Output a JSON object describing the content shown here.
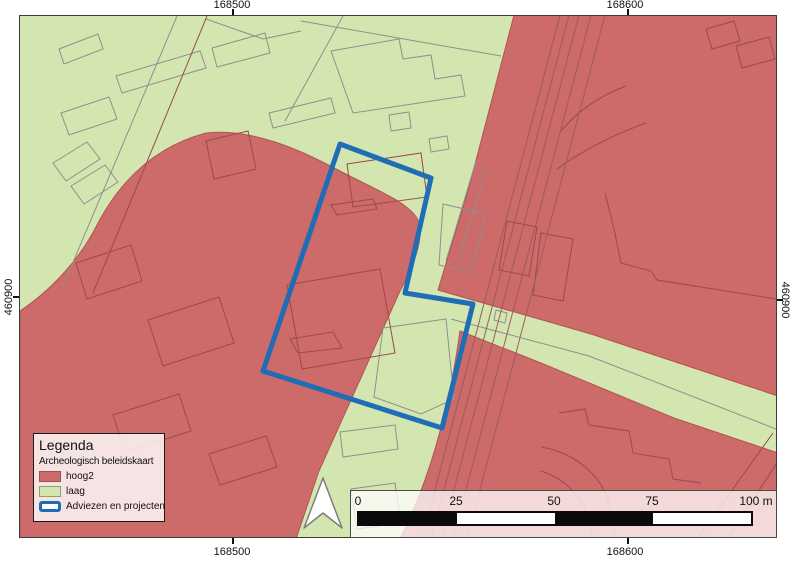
{
  "map_canvas": {
    "colors": {
      "laag": "#d3e6b0",
      "hoog2": "#cd6a6a",
      "hoog2_outline": "#b05454",
      "line_green": "#8f8f8f",
      "line_red": "#994b4b",
      "road": "#9c5d5d",
      "project_outline": "#1e6db6",
      "north_arrow_fill": "#ffffff",
      "north_arrow_stroke": "#7d7d7d"
    },
    "red_regions": [
      {
        "name": "west-high-zone",
        "d": "M19,310 C52,288 80,256 96,224 C118,182 152,146 205,132 C250,127 298,148 337,169 C375,189 408,201 417,219 C424,237 412,266 399,290 L318,470 L295,538 L19,538 Z"
      },
      {
        "name": "northeast-high-zone",
        "d": "M513,14 L777,14 L777,395 L590,333 L437,289 L467,190 Z"
      },
      {
        "name": "southeast-high-zone",
        "d": "M459,330 L540,362 L673,417 L777,452 L777,538 L399,538 Q442,452 459,330 Z"
      }
    ],
    "lines_green": [
      {
        "pts": [
          [
            58,
            48
          ],
          [
            97,
            33
          ],
          [
            102,
            48
          ],
          [
            63,
            63
          ]
        ],
        "closed": true
      },
      {
        "pts": [
          [
            115,
            75
          ],
          [
            199,
            50
          ],
          [
            205,
            67
          ],
          [
            121,
            92
          ]
        ],
        "closed": true
      },
      {
        "pts": [
          [
            60,
            112
          ],
          [
            108,
            96
          ],
          [
            116,
            118
          ],
          [
            68,
            134
          ]
        ],
        "closed": true
      },
      {
        "pts": [
          [
            211,
            47
          ],
          [
            264,
            32
          ],
          [
            269,
            52
          ],
          [
            216,
            66
          ]
        ],
        "closed": true
      },
      {
        "pts": [
          [
            205,
            18
          ],
          [
            262,
            38
          ],
          [
            300,
            30
          ]
        ],
        "closed": false
      },
      {
        "pts": [
          [
            268,
            112
          ],
          [
            330,
            97
          ],
          [
            334,
            112
          ],
          [
            272,
            127
          ]
        ],
        "closed": true
      },
      {
        "pts": [
          [
            52,
            162
          ],
          [
            86,
            141
          ],
          [
            99,
            158
          ],
          [
            65,
            180
          ]
        ],
        "closed": true
      },
      {
        "pts": [
          [
            70,
            185
          ],
          [
            104,
            164
          ],
          [
            117,
            181
          ],
          [
            83,
            203
          ]
        ],
        "closed": true
      },
      {
        "pts": [
          [
            176,
            15
          ],
          [
            62,
            285
          ]
        ],
        "closed": false
      },
      {
        "pts": [
          [
            342,
            15
          ],
          [
            284,
            120
          ]
        ],
        "closed": false
      },
      {
        "pts": [
          [
            300,
            20
          ],
          [
            500,
            55
          ]
        ],
        "closed": false
      },
      {
        "pts": [
          [
            330,
            50
          ],
          [
            398,
            38
          ],
          [
            402,
            58
          ],
          [
            430,
            54
          ],
          [
            434,
            78
          ],
          [
            460,
            74
          ],
          [
            464,
            95
          ],
          [
            352,
            112
          ]
        ],
        "closed": true
      },
      {
        "pts": [
          [
            388,
            114
          ],
          [
            408,
            111
          ],
          [
            410,
            127
          ],
          [
            390,
            130
          ]
        ],
        "closed": true
      },
      {
        "pts": [
          [
            428,
            138
          ],
          [
            446,
            135
          ],
          [
            448,
            148
          ],
          [
            430,
            151
          ]
        ],
        "closed": true
      },
      {
        "pts": [
          [
            382,
            327
          ],
          [
            445,
            318
          ],
          [
            453,
            398
          ],
          [
            420,
            413
          ],
          [
            373,
            396
          ]
        ],
        "closed": true
      },
      {
        "pts": [
          [
            339,
            431
          ],
          [
            394,
            424
          ],
          [
            397,
            448
          ],
          [
            342,
            456
          ]
        ],
        "closed": true
      },
      {
        "pts": [
          [
            350,
            488
          ],
          [
            394,
            482
          ],
          [
            400,
            522
          ],
          [
            356,
            528
          ]
        ],
        "closed": true
      },
      {
        "pts": [
          [
            442,
            203
          ],
          [
            485,
            213
          ],
          [
            470,
            272
          ],
          [
            438,
            264
          ]
        ],
        "closed": true
      },
      {
        "pts": [
          [
            475,
            160
          ],
          [
            445,
            260
          ]
        ],
        "closed": false
      },
      {
        "pts": [
          [
            486,
            165
          ],
          [
            456,
            265
          ]
        ],
        "closed": false
      },
      {
        "pts": [
          [
            450,
            318
          ],
          [
            588,
            355
          ],
          [
            775,
            428
          ]
        ],
        "closed": false
      },
      {
        "pts": [
          [
            495,
            309
          ],
          [
            506,
            312
          ],
          [
            504,
            322
          ],
          [
            493,
            319
          ]
        ],
        "closed": true
      }
    ],
    "lines_red": [
      {
        "pts": [
          [
            205,
            140
          ],
          [
            247,
            130
          ],
          [
            255,
            168
          ],
          [
            213,
            178
          ]
        ],
        "closed": true
      },
      {
        "pts": [
          [
            75,
            262
          ],
          [
            130,
            244
          ],
          [
            141,
            280
          ],
          [
            86,
            298
          ]
        ],
        "closed": true
      },
      {
        "pts": [
          [
            147,
            319
          ],
          [
            218,
            296
          ],
          [
            233,
            342
          ],
          [
            162,
            365
          ]
        ],
        "closed": true
      },
      {
        "pts": [
          [
            112,
            414
          ],
          [
            178,
            393
          ],
          [
            190,
            430
          ],
          [
            124,
            451
          ]
        ],
        "closed": true
      },
      {
        "pts": [
          [
            208,
            453
          ],
          [
            265,
            435
          ],
          [
            276,
            466
          ],
          [
            219,
            484
          ]
        ],
        "closed": true
      },
      {
        "pts": [
          [
            206,
            15
          ],
          [
            92,
            292
          ]
        ],
        "closed": false
      },
      {
        "pts": [
          [
            346,
            163
          ],
          [
            420,
            152
          ],
          [
            426,
            196
          ],
          [
            352,
            206
          ]
        ],
        "closed": true
      },
      {
        "pts": [
          [
            330,
            204
          ],
          [
            372,
            198
          ],
          [
            376,
            208
          ],
          [
            336,
            214
          ]
        ],
        "closed": true
      },
      {
        "pts": [
          [
            289,
            338
          ],
          [
            332,
            331
          ],
          [
            341,
            347
          ],
          [
            297,
            352
          ]
        ],
        "closed": true
      },
      {
        "pts": [
          [
            286,
            284
          ],
          [
            379,
            268
          ],
          [
            394,
            352
          ],
          [
            301,
            368
          ]
        ],
        "closed": true
      },
      {
        "pts": [
          [
            506,
            220
          ],
          [
            536,
            226
          ],
          [
            528,
            275
          ],
          [
            498,
            269
          ]
        ],
        "closed": true
      },
      {
        "pts": [
          [
            540,
            232
          ],
          [
            572,
            238
          ],
          [
            562,
            300
          ],
          [
            532,
            294
          ]
        ],
        "closed": true
      },
      {
        "pts": [
          [
            604,
            192
          ],
          [
            613,
            228
          ],
          [
            620,
            262
          ],
          [
            650,
            270
          ],
          [
            656,
            279
          ],
          [
            775,
            298
          ]
        ],
        "closed": false
      },
      {
        "pts": [
          [
            705,
            28
          ],
          [
            733,
            20
          ],
          [
            739,
            40
          ],
          [
            711,
            48
          ]
        ],
        "closed": true
      },
      {
        "pts": [
          [
            735,
            45
          ],
          [
            768,
            36
          ],
          [
            774,
            58
          ],
          [
            741,
            67
          ]
        ],
        "closed": true
      },
      {
        "pts": [
          [
            558,
            412
          ],
          [
            584,
            408
          ],
          [
            588,
            424
          ],
          [
            628,
            430
          ],
          [
            632,
            452
          ],
          [
            668,
            458
          ],
          [
            672,
            478
          ],
          [
            700,
            482
          ]
        ],
        "closed": false
      },
      {
        "pts": [
          [
            696,
            538
          ],
          [
            772,
            432
          ]
        ],
        "closed": false
      },
      {
        "pts": [
          [
            726,
            538
          ],
          [
            776,
            462
          ]
        ],
        "closed": false
      },
      {
        "d": "M540,446 Q575,452 596,478 Q612,500 614,538"
      },
      {
        "d": "M540,470 Q565,478 580,500 Q590,518 591,538"
      },
      {
        "d": "M560,130 Q585,100 625,85"
      },
      {
        "d": "M556,168 Q595,140 645,122"
      }
    ],
    "roads": [
      {
        "pts": [
          [
            421,
            538
          ],
          [
            559,
            14
          ]
        ],
        "closed": false
      },
      {
        "pts": [
          [
            430,
            538
          ],
          [
            568,
            14
          ]
        ],
        "closed": false
      },
      {
        "pts": [
          [
            440,
            538
          ],
          [
            578,
            14
          ]
        ],
        "closed": false
      },
      {
        "pts": [
          [
            452,
            538
          ],
          [
            590,
            14
          ]
        ],
        "closed": false
      },
      {
        "pts": [
          [
            466,
            538
          ],
          [
            604,
            14
          ]
        ],
        "closed": false
      }
    ],
    "project_polygon": {
      "name": "adviezen-en-projecten-outline",
      "points": "339,143 430,177 404,292 472,303 441,427 262,370"
    },
    "north_arrow": {
      "points": "322,477 303,527 322,512 341,527"
    }
  },
  "axis": {
    "top": [
      {
        "label": "168500",
        "x": 232
      },
      {
        "label": "168600",
        "x": 625
      }
    ],
    "bottom": [
      {
        "label": "168500",
        "x": 232
      },
      {
        "label": "168600",
        "x": 625
      }
    ],
    "left": [
      {
        "label": "460900",
        "y": 297
      }
    ],
    "right": [
      {
        "label": "460900",
        "y": 300
      }
    ]
  },
  "legend": {
    "title": "Legenda",
    "subtitle": "Archeologisch beleidskaart",
    "items": [
      {
        "label": "hoog2",
        "type": "fill",
        "color": "#cd6a6a",
        "border": "#9f5050"
      },
      {
        "label": "laag",
        "type": "fill",
        "color": "#d3e6b0",
        "border": "#8aa569"
      },
      {
        "label": "Adviezen en projecten",
        "type": "outline",
        "color": "#1e6db6"
      }
    ]
  },
  "scalebar": {
    "labels": [
      "0",
      "25",
      "50",
      "75"
    ],
    "end_label": "100 m",
    "label_x": [
      7,
      105,
      203,
      301,
      405
    ],
    "segment_colors": [
      "#0a0a0a",
      "#ffffff",
      "#0a0a0a",
      "#ffffff"
    ]
  }
}
